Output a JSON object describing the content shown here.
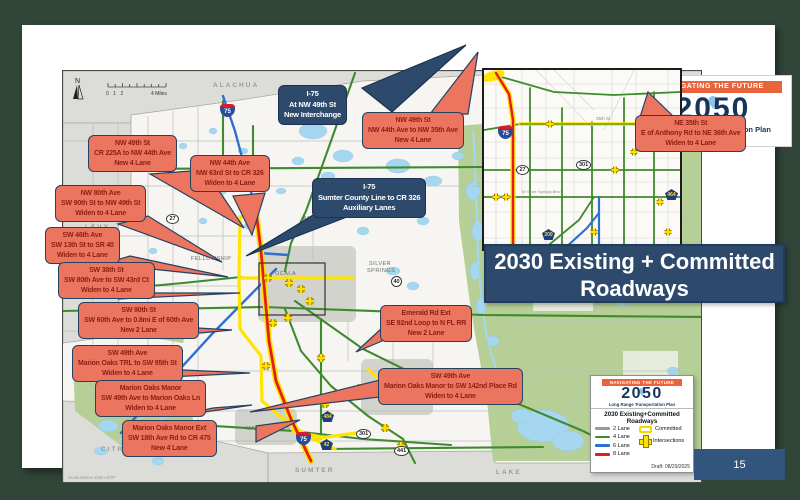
{
  "page": {
    "number": "15"
  },
  "title_box": {
    "line1": "2030 Existing + Committed",
    "line2": "Roadways"
  },
  "logo": {
    "banner": "NAVIGATING THE FUTURE",
    "year": "2050",
    "subtitle": "Long Range Transportation Plan"
  },
  "legend": {
    "banner": "NAVIGATING THE FUTURE",
    "year": "2050",
    "subtitle": "Long Range Transportation Plan",
    "title": "2030 Existing+Committed Roadways",
    "lanes": [
      {
        "label": "2 Lane",
        "color": "#9A9A9A"
      },
      {
        "label": "4 Lane",
        "color": "#3F8A2E"
      },
      {
        "label": "6 Lane",
        "color": "#2F6FD0"
      },
      {
        "label": "8 Lane",
        "color": "#E51C1D"
      }
    ],
    "committed_label": "Committed",
    "intersections_label": "Intersections",
    "draft": "Draft: 08/29/2025"
  },
  "colors": {
    "callout_salmon": "#EC7560",
    "callout_navy": "#2D4A6D",
    "committed_yellow": "#FFE400",
    "title_bg": "#2D4A6D",
    "accent_orange": "#E8643C",
    "forest_green": "#B5CF97",
    "water_blue": "#A6D7F0"
  },
  "map": {
    "north_label": "N",
    "scale": {
      "t0": "0",
      "t1": "1",
      "t2": "2",
      "t4": "4 Miles"
    },
    "attribution": "Ocala Marion 2050 LRTP",
    "counties": {
      "alachua": "ALACHUA",
      "levy": "LEVY",
      "citrus": "CITRUS",
      "sumter": "SUMTER",
      "lake": "LAKE"
    },
    "places": {
      "ocala": "OCALA",
      "anthony": "ANTHONY",
      "silver_springs_1": "SILVER",
      "silver_springs_2": "SPRINGS",
      "fellowship": "FELLOWSHIP",
      "marion_oaks": "MARION OAKS"
    },
    "shields": {
      "i75_top": "75",
      "i75_south": "75",
      "us27": "27",
      "sr40": "40",
      "us301": "301",
      "us441": "441",
      "cr484": "484",
      "cr42": "42"
    }
  },
  "inset": {
    "street_35th": "35th St",
    "silver_springs_blvd": "W Silver Springs Blvd",
    "shields": {
      "i75": "75",
      "us27": "27",
      "us301": "301",
      "cr200": "200",
      "cr464": "464"
    }
  },
  "callouts": {
    "c1": {
      "l1": "I-75",
      "l2": "At NW 49th St",
      "l3": "New Interchange"
    },
    "c2": {
      "l1": "NW 49th St",
      "l2": "CR 225A to NW 44th Ave",
      "l3": "New 4 Lane"
    },
    "c3": {
      "l1": "NW 44th Ave",
      "l2": "NW 63rd St to CR 326",
      "l3": "Widen to 4 Lane"
    },
    "c4": {
      "l1": "NW 80th Ave",
      "l2": "SW 90th St to NW 49th St",
      "l3": "Widen to 4 Lane"
    },
    "c5": {
      "l1": "SW 46th Ave",
      "l2": "SW 13th St to SR 40",
      "l3": "Widen to 4 Lane"
    },
    "c6": {
      "l1": "SW 38th St",
      "l2": "SW 80th Ave to SW 43rd Ct",
      "l3": "Widen to 4 Lane"
    },
    "c7": {
      "l1": "SW 90th St",
      "l2": "SW 60th Ave to 0.8mi E of 60th Ave",
      "l3": "New 2 Lane"
    },
    "c8": {
      "l1": "SW 49th Ave",
      "l2": "Marion Oaks TRL to SW 95th St",
      "l3": "Widen to 4 Lane"
    },
    "c9": {
      "l1": "Marion Oaks Manor",
      "l2": "SW 49th Ave to Marion Oaks Ln",
      "l3": "Widen to 4 Lane"
    },
    "c10": {
      "l1": "Marion Oaks Manor Ext",
      "l2": "SW 18th Ave Rd to CR 475",
      "l3": "New 4 Lane"
    },
    "c11": {
      "l1": "I-75",
      "l2": "Sumter County Line to CR 326",
      "l3": "Auxiliary Lanes"
    },
    "c12": {
      "l1": "NW 49th St",
      "l2": "NW 44th Ave to NW 35th Ave",
      "l3": "New 4 Lane"
    },
    "c13": {
      "l1": "NE 35th St",
      "l2": "E of Anthony Rd to NE 36th Ave",
      "l3": "Widen to 4 Lane"
    },
    "c14": {
      "l1": "Emerald Rd Ext",
      "l2": "SE 92nd Loop to N FL RR",
      "l3": "New 2 Lane"
    },
    "c15": {
      "l1": "SW 49th Ave",
      "l2": "Marion Oaks Manor to SW 142nd Place Rd",
      "l3": "Widen to 4 Lane"
    }
  }
}
